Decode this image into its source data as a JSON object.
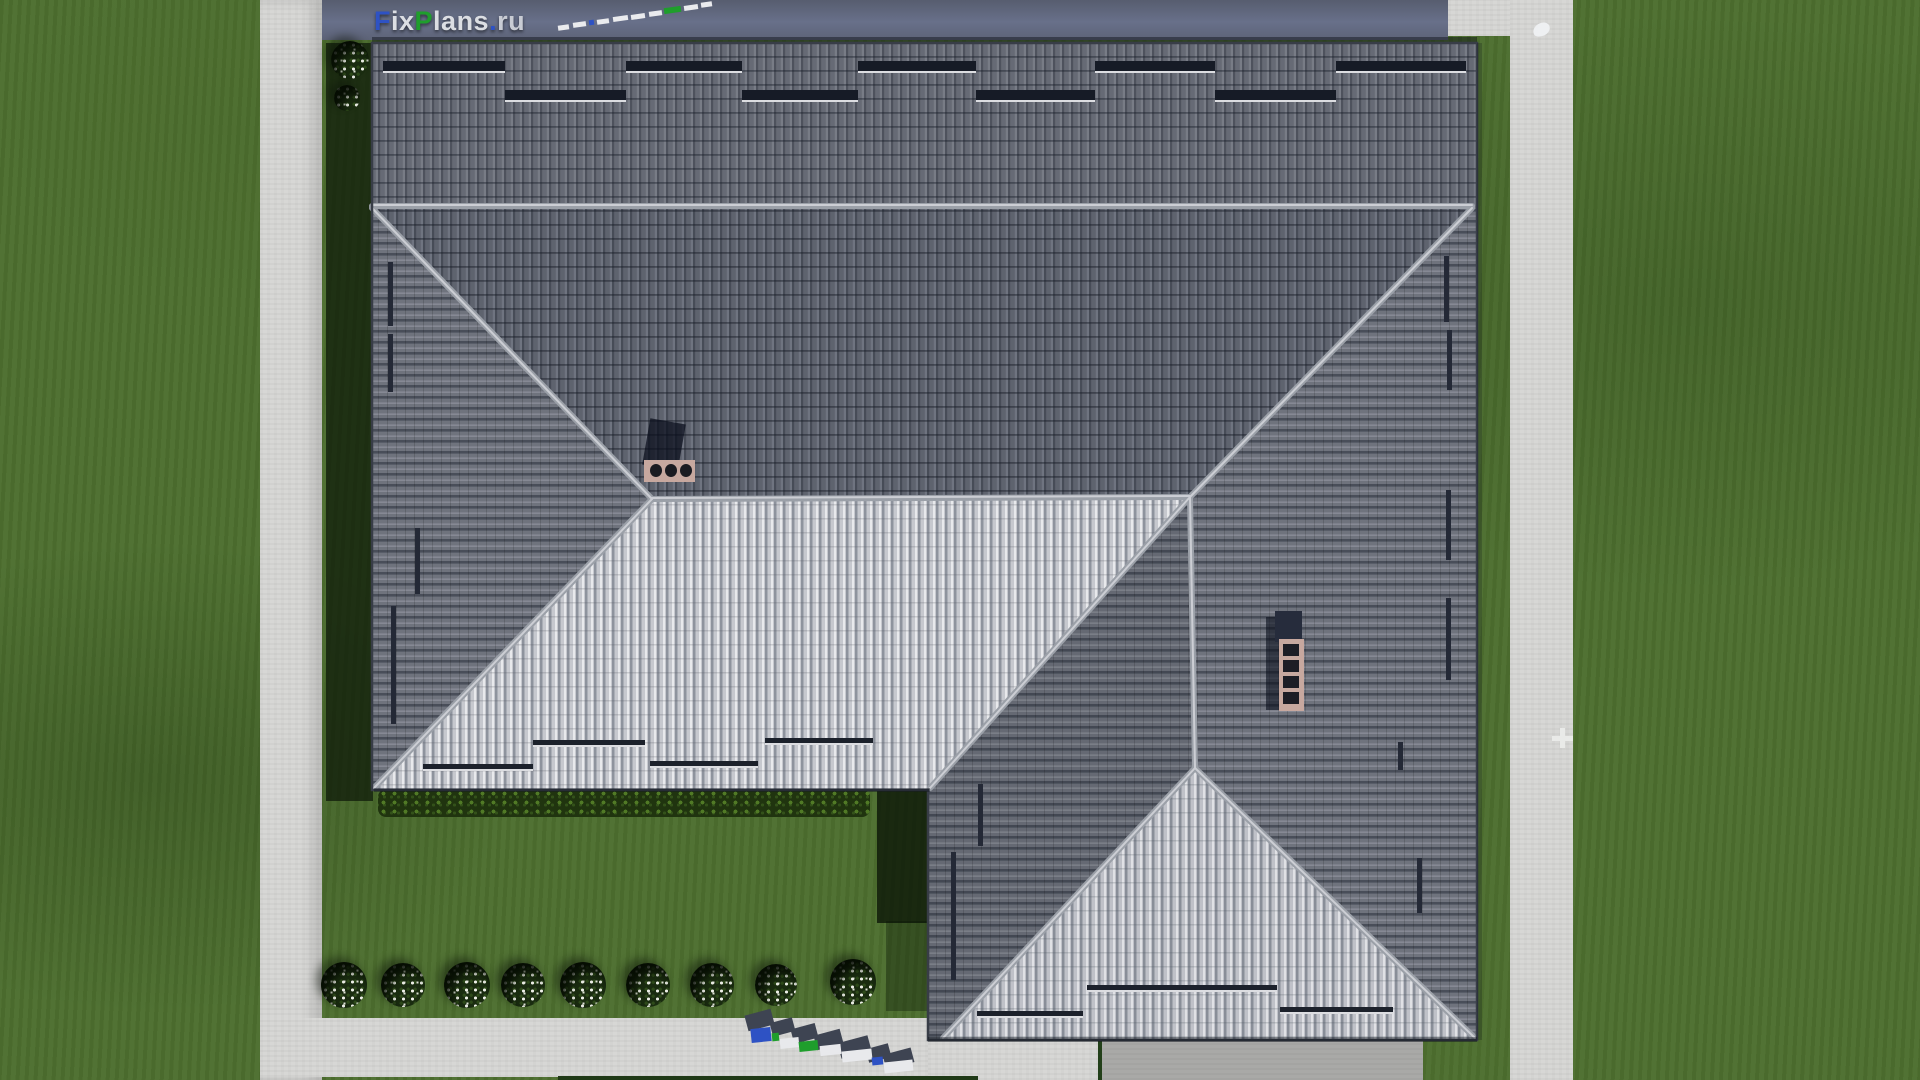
{
  "watermark": {
    "brand": "FixPlans.ru",
    "top_logo_letters": [
      {
        "t": "F",
        "c": "#2e52c4"
      },
      {
        "t": "ix",
        "c": "#dcdee3"
      },
      {
        "t": "P",
        "c": "#1f9e2c"
      },
      {
        "t": "lans",
        "c": "#dcdee3"
      },
      {
        "t": ".",
        "c": "#2e52c4"
      },
      {
        "t": "ru",
        "c": "#c9ccd4"
      }
    ]
  },
  "palette": {
    "grass": "#4d6f2f",
    "grass_shadow": "#0d1a08",
    "sidewalk": "#d7d7d5",
    "road": "#616880",
    "driveway": "#a9a9a7",
    "roof_dark_tile": "#60646f",
    "roof_light_tile": "#c6c8ce",
    "ridge_cap": "#a6aab2",
    "snow_guard": "#161b26",
    "chimney": "#c7a89f",
    "logo_blue": "#2e52c4",
    "logo_green": "#1f9e2c"
  },
  "decor": {
    "bushes": [
      {
        "name": "flower-bush",
        "x": 344,
        "y": 985,
        "d": 46
      },
      {
        "name": "flower-bush",
        "x": 403,
        "y": 985,
        "d": 44
      },
      {
        "name": "flower-bush",
        "x": 467,
        "y": 985,
        "d": 46
      },
      {
        "name": "flower-bush",
        "x": 523,
        "y": 985,
        "d": 44
      },
      {
        "name": "flower-bush",
        "x": 583,
        "y": 985,
        "d": 46
      },
      {
        "name": "flower-bush",
        "x": 648,
        "y": 985,
        "d": 44
      },
      {
        "name": "flower-bush",
        "x": 712,
        "y": 985,
        "d": 44
      },
      {
        "name": "flower-bush",
        "x": 776,
        "y": 985,
        "d": 42
      },
      {
        "name": "flower-bush",
        "x": 853,
        "y": 982,
        "d": 46
      },
      {
        "name": "flower-bush",
        "x": 350,
        "y": 60,
        "d": 38
      },
      {
        "name": "flower-bush",
        "x": 347,
        "y": 98,
        "d": 26
      }
    ],
    "rects": [
      {
        "name": "shadow-west-eave",
        "x": 326,
        "y": 43,
        "w": 47,
        "h": 758,
        "c": "rgba(13,23,8,0.72)",
        "z": 6
      },
      {
        "name": "shadow-wing-west-wall",
        "x": 877,
        "y": 791,
        "w": 52,
        "h": 132,
        "c": "rgba(10,20,7,0.78)",
        "z": 6
      },
      {
        "name": "shadow-wing-west-soft",
        "x": 886,
        "y": 921,
        "w": 43,
        "h": 90,
        "c": "rgba(10,20,7,0.35)",
        "z": 6
      },
      {
        "name": "shadow-tree-edge",
        "x": 1880,
        "y": 26,
        "w": 40,
        "h": 142,
        "c": "rgba(8,18,6,0.8),",
        "br": "45%",
        "z": 6
      },
      {
        "name": "shadow-top-eave",
        "x": 372,
        "y": 37,
        "w": 1105,
        "h": 7,
        "c": "rgba(10,14,22,0.45)",
        "z": 6
      },
      {
        "name": "shadow-east-eave",
        "x": 1477,
        "y": 43,
        "w": 5,
        "h": 997,
        "c": "rgba(10,14,22,0.22)",
        "z": 12
      },
      {
        "name": "shadow-light-roof-eave",
        "x": 374,
        "y": 788,
        "w": 556,
        "h": 4,
        "c": "rgba(10,14,22,0.35)",
        "z": 12
      },
      {
        "name": "shadow-wing-south-eave",
        "x": 928,
        "y": 1037,
        "w": 549,
        "h": 5,
        "c": "rgba(10,14,22,0.4)",
        "z": 12
      },
      {
        "name": "lawn-edge-line",
        "x": 558,
        "y": 1076,
        "w": 420,
        "h": 4,
        "c": "#1f3916",
        "z": 5
      },
      {
        "name": "driveway-edge-line",
        "x": 1098,
        "y": 1039,
        "w": 4,
        "h": 41,
        "c": "#23401a",
        "z": 5
      },
      {
        "name": "snow-guard-bar",
        "x": 383,
        "y": 61,
        "w": 122,
        "h": 10,
        "c": "#161b26",
        "u": 1,
        "z": 20
      },
      {
        "name": "snow-guard-bar",
        "x": 626,
        "y": 61,
        "w": 116,
        "h": 10,
        "c": "#161b26",
        "u": 1,
        "z": 20
      },
      {
        "name": "snow-guard-bar",
        "x": 858,
        "y": 61,
        "w": 118,
        "h": 10,
        "c": "#161b26",
        "u": 1,
        "z": 20
      },
      {
        "name": "snow-guard-bar",
        "x": 1095,
        "y": 61,
        "w": 120,
        "h": 10,
        "c": "#161b26",
        "u": 1,
        "z": 20
      },
      {
        "name": "snow-guard-bar",
        "x": 1336,
        "y": 61,
        "w": 130,
        "h": 10,
        "c": "#161b26",
        "u": 1,
        "z": 20
      },
      {
        "name": "snow-guard-bar",
        "x": 505,
        "y": 90,
        "w": 121,
        "h": 10,
        "c": "#161b26",
        "u": 1,
        "z": 20
      },
      {
        "name": "snow-guard-bar",
        "x": 742,
        "y": 90,
        "w": 116,
        "h": 10,
        "c": "#161b26",
        "u": 1,
        "z": 20
      },
      {
        "name": "snow-guard-bar",
        "x": 976,
        "y": 90,
        "w": 119,
        "h": 10,
        "c": "#161b26",
        "u": 1,
        "z": 20
      },
      {
        "name": "snow-guard-bar",
        "x": 1215,
        "y": 90,
        "w": 121,
        "h": 10,
        "c": "#161b26",
        "u": 1,
        "z": 20
      },
      {
        "name": "snow-guard-bar",
        "x": 423,
        "y": 764,
        "w": 110,
        "h": 5,
        "c": "#1c212b",
        "u": 1,
        "z": 20
      },
      {
        "name": "snow-guard-bar",
        "x": 533,
        "y": 740,
        "w": 112,
        "h": 5,
        "c": "#1c212b",
        "u": 1,
        "z": 20
      },
      {
        "name": "snow-guard-bar",
        "x": 650,
        "y": 761,
        "w": 108,
        "h": 5,
        "c": "#1c212b",
        "u": 1,
        "z": 20
      },
      {
        "name": "snow-guard-bar",
        "x": 765,
        "y": 738,
        "w": 108,
        "h": 5,
        "c": "#1c212b",
        "u": 1,
        "z": 20
      },
      {
        "name": "snow-guard-bar",
        "x": 977,
        "y": 1011,
        "w": 106,
        "h": 5,
        "c": "#1c212b",
        "u": 1,
        "z": 20
      },
      {
        "name": "snow-guard-bar",
        "x": 1087,
        "y": 985,
        "w": 190,
        "h": 5,
        "c": "#1c212b",
        "u": 1,
        "z": 20
      },
      {
        "name": "snow-guard-bar",
        "x": 1280,
        "y": 1007,
        "w": 113,
        "h": 5,
        "c": "#1c212b",
        "u": 1,
        "z": 20
      },
      {
        "name": "snow-guard-bar-v",
        "x": 388,
        "y": 262,
        "w": 5,
        "h": 64,
        "c": "#242936",
        "z": 20
      },
      {
        "name": "snow-guard-bar-v",
        "x": 388,
        "y": 334,
        "w": 5,
        "h": 58,
        "c": "#242936",
        "z": 20
      },
      {
        "name": "snow-guard-bar-v",
        "x": 415,
        "y": 528,
        "w": 5,
        "h": 66,
        "c": "#242936",
        "z": 20
      },
      {
        "name": "snow-guard-bar-v",
        "x": 391,
        "y": 606,
        "w": 5,
        "h": 118,
        "c": "#242936",
        "z": 20
      },
      {
        "name": "snow-guard-bar-v",
        "x": 1444,
        "y": 256,
        "w": 5,
        "h": 66,
        "c": "#242936",
        "z": 20
      },
      {
        "name": "snow-guard-bar-v",
        "x": 1447,
        "y": 330,
        "w": 5,
        "h": 60,
        "c": "#242936",
        "z": 20
      },
      {
        "name": "snow-guard-bar-v",
        "x": 1446,
        "y": 490,
        "w": 5,
        "h": 70,
        "c": "#242936",
        "z": 20
      },
      {
        "name": "snow-guard-bar-v",
        "x": 1446,
        "y": 598,
        "w": 5,
        "h": 82,
        "c": "#242936",
        "z": 20
      },
      {
        "name": "snow-guard-bar-v",
        "x": 1398,
        "y": 742,
        "w": 5,
        "h": 28,
        "c": "#242936",
        "z": 20
      },
      {
        "name": "snow-guard-bar-v",
        "x": 1417,
        "y": 858,
        "w": 5,
        "h": 55,
        "c": "#242936",
        "z": 20
      },
      {
        "name": "snow-guard-bar-v",
        "x": 978,
        "y": 784,
        "w": 5,
        "h": 62,
        "c": "#242936",
        "z": 20
      },
      {
        "name": "snow-guard-bar-v",
        "x": 951,
        "y": 852,
        "w": 5,
        "h": 128,
        "c": "#242936",
        "z": 20
      },
      {
        "name": "chimney-shadow",
        "x": 646,
        "y": 421,
        "w": 36,
        "h": 47,
        "c": "rgba(9,13,27,0.72)",
        "rot": 10,
        "z": 22
      },
      {
        "name": "chimney-body",
        "x": 644,
        "y": 460,
        "w": 51,
        "h": 22,
        "c": "#c7a89f",
        "z": 22
      },
      {
        "name": "chimney-flue",
        "x": 650,
        "y": 464,
        "w": 12,
        "h": 13,
        "c": "#1b1b21",
        "br": "50%",
        "z": 23
      },
      {
        "name": "chimney-flue",
        "x": 665,
        "y": 464,
        "w": 12,
        "h": 13,
        "c": "#1b1b21",
        "br": "50%",
        "z": 23
      },
      {
        "name": "chimney-flue",
        "x": 680,
        "y": 464,
        "w": 12,
        "h": 13,
        "c": "#1b1b21",
        "br": "50%",
        "z": 23
      },
      {
        "name": "chimney-shadow",
        "x": 1266,
        "y": 617,
        "w": 15,
        "h": 93,
        "c": "rgba(9,13,27,0.6)",
        "z": 22
      },
      {
        "name": "chimney-cap",
        "x": 1275,
        "y": 611,
        "w": 27,
        "h": 31,
        "c": "#262c3c",
        "z": 22
      },
      {
        "name": "chimney-body",
        "x": 1279,
        "y": 639,
        "w": 25,
        "h": 72,
        "c": "#c7a89f",
        "z": 22
      },
      {
        "name": "chimney-flue",
        "x": 1283,
        "y": 644,
        "w": 16,
        "h": 12,
        "c": "#1d1d25",
        "z": 23
      },
      {
        "name": "chimney-flue",
        "x": 1283,
        "y": 660,
        "w": 16,
        "h": 12,
        "c": "#1d1d25",
        "z": 23
      },
      {
        "name": "chimney-flue",
        "x": 1283,
        "y": 676,
        "w": 16,
        "h": 12,
        "c": "#1d1d25",
        "z": 23
      },
      {
        "name": "chimney-flue",
        "x": 1283,
        "y": 692,
        "w": 16,
        "h": 12,
        "c": "#1d1d25",
        "z": 23
      },
      {
        "name": "bird",
        "x": 1533,
        "y": 23,
        "w": 17,
        "h": 13,
        "c": "#eef0f2",
        "br": "60% 40% 55% 35%",
        "rot": -14,
        "z": 8
      },
      {
        "name": "path-mark",
        "x": 1552,
        "y": 736,
        "w": 21,
        "h": 5,
        "c": "#e9eae8",
        "z": 8
      },
      {
        "name": "path-mark",
        "x": 1560,
        "y": 728,
        "w": 5,
        "h": 20,
        "c": "#e9eae8",
        "z": 8
      },
      {
        "name": "road-watermark-dash",
        "x": 558,
        "y": 25,
        "w": 11,
        "h": 5,
        "c": "#eaebee",
        "rot": -8,
        "z": 30
      },
      {
        "name": "road-watermark-dash",
        "x": 573,
        "y": 22,
        "w": 13,
        "h": 5,
        "c": "#eaebee",
        "rot": -8,
        "z": 30
      },
      {
        "name": "road-watermark-dash",
        "x": 589,
        "y": 20,
        "w": 5,
        "h": 5,
        "c": "#2e52c4",
        "rot": -8,
        "z": 30
      },
      {
        "name": "road-watermark-dash",
        "x": 597,
        "y": 19,
        "w": 12,
        "h": 5,
        "c": "#eaebee",
        "rot": -8,
        "z": 30
      },
      {
        "name": "road-watermark-dash",
        "x": 613,
        "y": 16,
        "w": 15,
        "h": 5,
        "c": "#eaebee",
        "rot": -8,
        "z": 30
      },
      {
        "name": "road-watermark-dash",
        "x": 631,
        "y": 14,
        "w": 14,
        "h": 5,
        "c": "#eaebee",
        "rot": -8,
        "z": 30
      },
      {
        "name": "road-watermark-dash",
        "x": 649,
        "y": 11,
        "w": 13,
        "h": 5,
        "c": "#eaebee",
        "rot": -8,
        "z": 30
      },
      {
        "name": "road-watermark-dash",
        "x": 664,
        "y": 7,
        "w": 17,
        "h": 6,
        "c": "#1f9e2c",
        "rot": -8,
        "z": 30
      },
      {
        "name": "road-watermark-dash",
        "x": 684,
        "y": 5,
        "w": 14,
        "h": 5,
        "c": "#eaebee",
        "rot": -8,
        "z": 30
      },
      {
        "name": "road-watermark-dash",
        "x": 701,
        "y": 2,
        "w": 11,
        "h": 5,
        "c": "#eaebee",
        "rot": -8,
        "z": 30
      },
      {
        "name": "bottom-watermark-shadow",
        "x": 746,
        "y": 1012,
        "w": 27,
        "h": 16,
        "c": "#3e4452",
        "rot": -15,
        "z": 30
      },
      {
        "name": "bottom-watermark-shadow",
        "x": 771,
        "y": 1020,
        "w": 23,
        "h": 14,
        "c": "#3e4452",
        "rot": -15,
        "z": 30
      },
      {
        "name": "bottom-watermark-shadow",
        "x": 792,
        "y": 1026,
        "w": 25,
        "h": 15,
        "c": "#3e4452",
        "rot": -15,
        "z": 30
      },
      {
        "name": "bottom-watermark-shadow",
        "x": 815,
        "y": 1032,
        "w": 27,
        "h": 15,
        "c": "#3e4452",
        "rot": -15,
        "z": 30
      },
      {
        "name": "bottom-watermark-shadow",
        "x": 839,
        "y": 1039,
        "w": 31,
        "h": 16,
        "c": "#3e4452",
        "rot": -15,
        "z": 30
      },
      {
        "name": "bottom-watermark-shadow",
        "x": 867,
        "y": 1046,
        "w": 23,
        "h": 14,
        "c": "#3e4452",
        "rot": -15,
        "z": 30
      },
      {
        "name": "bottom-watermark-shadow",
        "x": 884,
        "y": 1051,
        "w": 29,
        "h": 15,
        "c": "#3e4452",
        "rot": -15,
        "z": 30
      },
      {
        "name": "bottom-watermark-letter",
        "x": 751,
        "y": 1028,
        "w": 20,
        "h": 14,
        "c": "#2e52c4",
        "rot": -6,
        "z": 31
      },
      {
        "name": "bottom-watermark-letter",
        "x": 772,
        "y": 1033,
        "w": 7,
        "h": 8,
        "c": "#1f9e2c",
        "rot": -6,
        "z": 31
      },
      {
        "name": "bottom-watermark-letter",
        "x": 780,
        "y": 1038,
        "w": 19,
        "h": 10,
        "c": "#e8e9ec",
        "rot": -6,
        "z": 31
      },
      {
        "name": "bottom-watermark-letter",
        "x": 799,
        "y": 1041,
        "w": 19,
        "h": 10,
        "c": "#1f9e2c",
        "rot": -6,
        "z": 31
      },
      {
        "name": "bottom-watermark-letter",
        "x": 820,
        "y": 1045,
        "w": 21,
        "h": 10,
        "c": "#e8e9ec",
        "rot": -6,
        "z": 31
      },
      {
        "name": "bottom-watermark-letter",
        "x": 842,
        "y": 1050,
        "w": 30,
        "h": 11,
        "c": "#e8e9ec",
        "rot": -6,
        "z": 31
      },
      {
        "name": "bottom-watermark-letter",
        "x": 872,
        "y": 1057,
        "w": 11,
        "h": 8,
        "c": "#2e52c4",
        "rot": -6,
        "z": 31
      },
      {
        "name": "bottom-watermark-letter",
        "x": 884,
        "y": 1061,
        "w": 29,
        "h": 11,
        "c": "#e8e9ec",
        "rot": -6,
        "z": 31
      }
    ]
  }
}
